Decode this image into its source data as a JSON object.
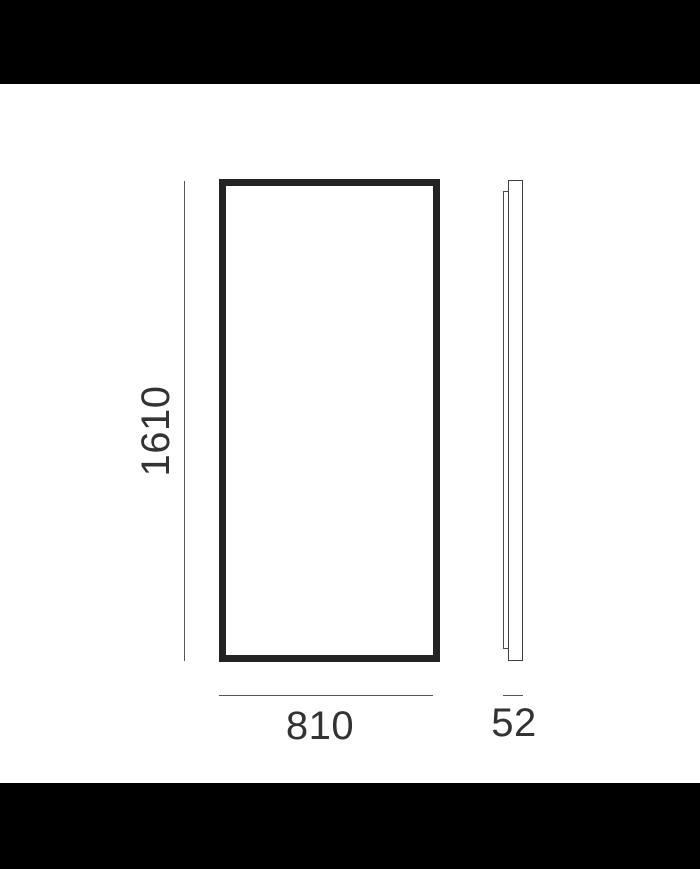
{
  "diagram": {
    "type": "product-dimension-drawing",
    "description": "Technical line drawing of a rectangular panel/mirror: front elevation and side profile with millimetre dimensions",
    "views": {
      "front": "front-elevation",
      "side": "side-profile"
    },
    "dimensions": {
      "height": "1610",
      "width": "810",
      "depth": "52"
    },
    "colors": {
      "background": "#ffffff",
      "letterbox_band": "#000000",
      "frame_stroke": "#232323",
      "profile_stroke": "#404040",
      "dimension_line": "#555555",
      "label_text": "#333333"
    }
  }
}
